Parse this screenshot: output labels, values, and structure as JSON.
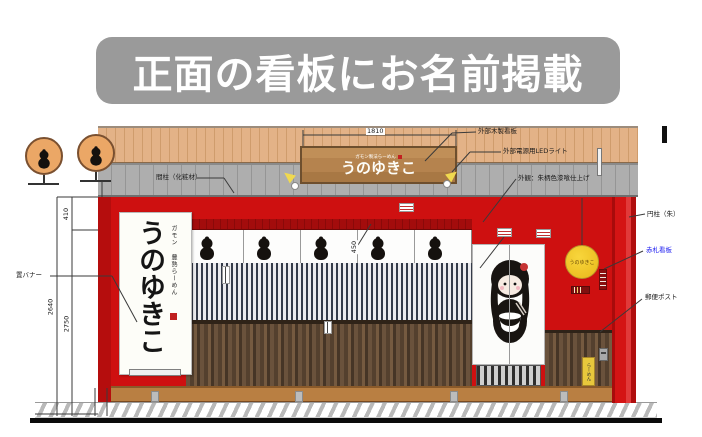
{
  "header": {
    "title": "正面の看板にお名前掲載"
  },
  "signboard": {
    "sub": "ガモン製法らーめん",
    "main": "うのゆきこ"
  },
  "standing_banner": {
    "label": "置バナー",
    "sub": "ガモン 豊熟らーめん",
    "main": "うのゆきこ"
  },
  "round_sign": {
    "text": "うのゆきこ"
  },
  "yellow_sign": {
    "text": "らーめん"
  },
  "dimensions": {
    "sign_width": "1810",
    "upper": "410",
    "lower": "2750",
    "total": "2640",
    "noren_height": "450"
  },
  "annotations": {
    "wood_sign": "外部木製看板",
    "led_light": "外部電源用LEDライト",
    "wall_finish": "外観：朱柄色漆喰仕上げ",
    "stud": "間柱（化粧材）",
    "column": "円柱（朱）",
    "red_tag": "赤札看板",
    "mailbox": "郵便ポスト"
  },
  "colors": {
    "wall_red": "#ce1010",
    "header_gray": "#9a9a9a",
    "signboard_wood": "#b5834e",
    "accent_yellow": "#e8b81a",
    "tag_blue": "#1a1af0"
  }
}
